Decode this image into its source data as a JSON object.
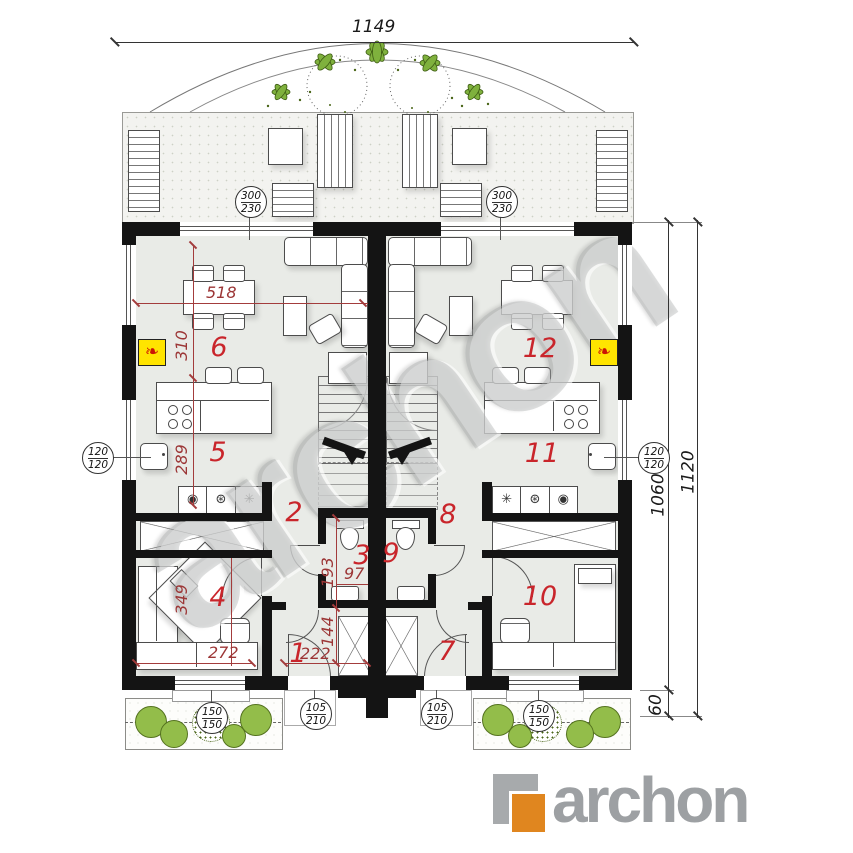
{
  "watermark": "archon",
  "logo": {
    "text": "archon"
  },
  "dimensions": {
    "overall_width": "1149",
    "overall_height": "1120",
    "main_depth": "1060",
    "porch_depth": "60",
    "living_width": "518",
    "dining_depth": "310",
    "kitchen_depth": "289",
    "bedroom_depth": "349",
    "bedroom_width": "272",
    "hall_width": "222",
    "hall_depth": "144",
    "bath_depth": "193",
    "bath_width": "97"
  },
  "rooms": {
    "r1": "1",
    "r2": "2",
    "r3": "3",
    "r4": "4",
    "r5": "5",
    "r6": "6",
    "r7": "7",
    "r8": "8",
    "r9": "9",
    "r10": "10",
    "r11": "11",
    "r12": "12"
  },
  "stamps": {
    "terrace_door_left": {
      "a": "300",
      "b": "230"
    },
    "terrace_door_right": {
      "a": "300",
      "b": "230"
    },
    "side_window_left": {
      "a": "120",
      "b": "120"
    },
    "side_window_right": {
      "a": "120",
      "b": "120"
    },
    "entry_door_left": {
      "a": "105",
      "b": "210"
    },
    "entry_door_right": {
      "a": "105",
      "b": "210"
    },
    "front_window_left": {
      "a": "150",
      "b": "150"
    },
    "front_window_right": {
      "a": "150",
      "b": "150"
    }
  },
  "appliances": {
    "left": [
      "◉",
      "⊛",
      "✳"
    ],
    "right": [
      "✳",
      "⊛",
      "◉"
    ]
  },
  "fireplace_glyph": "❧",
  "colors": {
    "wall": "#141414",
    "floor": "#e9ebe7",
    "dim_red": "#a33c3c",
    "room_red": "#c9252b",
    "plant_green": "#93bd4a",
    "fireplace_yellow": "#ffe400",
    "logo_gray": "#9da0a3",
    "logo_orange": "#e0861f"
  }
}
